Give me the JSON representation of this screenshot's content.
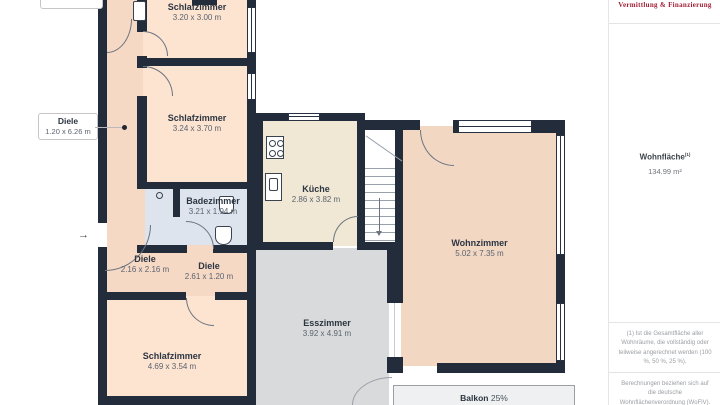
{
  "plan": {
    "rooms": {
      "bed_top": {
        "name": "Schlafzimmer",
        "dims": "3.20 x 3.00 m"
      },
      "bed_mid": {
        "name": "Schlafzimmer",
        "dims": "3.24 x 3.70 m"
      },
      "hall_long": {
        "name": "Diele",
        "dims": "1.20 x 6.26 m"
      },
      "bath": {
        "name": "Badezimmer",
        "dims": "3.21 x 1.94 m"
      },
      "kitchen": {
        "name": "Küche",
        "dims": "2.86 x 3.82 m"
      },
      "living": {
        "name": "Wohnzimmer",
        "dims": "5.02 x 7.35 m"
      },
      "hall_mid": {
        "name": "Diele",
        "dims": "2.16 x 2.16 m"
      },
      "hall_small": {
        "name": "Diele",
        "dims": "2.61 x 1.20 m"
      },
      "dining": {
        "name": "Esszimmer",
        "dims": "3.92 x 4.91 m"
      },
      "bed_bottom": {
        "name": "Schlafzimmer",
        "dims": "4.69 x 3.54 m"
      },
      "balcony": {
        "name": "Balkon",
        "share": "25%",
        "dims": "5.08 x 1.50 m"
      }
    },
    "colors": {
      "wall": "#232c3b",
      "bedroom": "#fce4d0",
      "hall": "#f6d9c4",
      "bath": "#dde4ed",
      "kitchen": "#f0e8d5",
      "living": "#f2d7c3",
      "dining": "#d9dadb",
      "balcony": "#eef0f1"
    }
  },
  "sidebar": {
    "brand_tagline": "Vermittlung & Finanzierung",
    "area_label": "Wohnfläche",
    "area_sup": "(1)",
    "area_value": "134.99 m²",
    "footnote_1": "(1) Ist die Gesamtfläche aller Wohnräume, die vollständig oder teilweise angerechnet werden (100 %, 50 %, 25 %).",
    "footnote_2": "Berechnungen beziehen sich auf die deutsche Wohnflächenverordnung (WoFlV). Maße sind ungefähre Angaben"
  }
}
